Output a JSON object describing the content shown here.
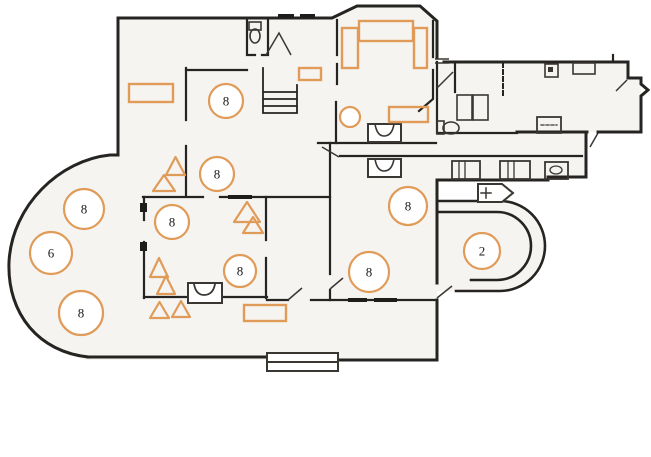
{
  "drawing": {
    "type": "building-floor-plan-with-annotations",
    "colors": {
      "marker": "#E09B58",
      "ink": "#262422",
      "paper": "#FFFFFF",
      "wash": "#F5F4F1",
      "label_color": "#1A1A1A"
    },
    "circle_markers": [
      {
        "id": "c1",
        "label": "8",
        "x": 226,
        "y": 101,
        "r": 17
      },
      {
        "id": "c2",
        "label": "8",
        "x": 217,
        "y": 174,
        "r": 17
      },
      {
        "id": "c3",
        "label": "8",
        "x": 84,
        "y": 209,
        "r": 20
      },
      {
        "id": "c4",
        "label": "8",
        "x": 172,
        "y": 222,
        "r": 17
      },
      {
        "id": "c5",
        "label": "6",
        "x": 51,
        "y": 253,
        "r": 21
      },
      {
        "id": "c6",
        "label": "8",
        "x": 81,
        "y": 313,
        "r": 22
      },
      {
        "id": "c7",
        "label": "8",
        "x": 240,
        "y": 271,
        "r": 16
      },
      {
        "id": "c8",
        "label": "8",
        "x": 369,
        "y": 272,
        "r": 20
      },
      {
        "id": "c9",
        "label": "8",
        "x": 408,
        "y": 206,
        "r": 19
      },
      {
        "id": "c10",
        "label": "2",
        "x": 482,
        "y": 251,
        "r": 18
      },
      {
        "id": "c11",
        "label": "",
        "x": 350,
        "y": 117,
        "r": 10
      }
    ],
    "triangle_markers": [
      {
        "id": "t1",
        "x": 166,
        "y": 157,
        "w": 19,
        "h": 18
      },
      {
        "id": "t2",
        "x": 153,
        "y": 175,
        "w": 22,
        "h": 16
      },
      {
        "id": "t3",
        "x": 150,
        "y": 258,
        "w": 18,
        "h": 19
      },
      {
        "id": "t4",
        "x": 157,
        "y": 276,
        "w": 18,
        "h": 18
      },
      {
        "id": "t5",
        "x": 150,
        "y": 302,
        "w": 19,
        "h": 16
      },
      {
        "id": "t6",
        "x": 172,
        "y": 301,
        "w": 18,
        "h": 16
      },
      {
        "id": "t7",
        "x": 234,
        "y": 202,
        "w": 26,
        "h": 20
      },
      {
        "id": "t8",
        "x": 243,
        "y": 217,
        "w": 20,
        "h": 16
      }
    ],
    "rect_markers": [
      {
        "id": "r1",
        "x": 129,
        "y": 84,
        "w": 44,
        "h": 18
      },
      {
        "id": "r2",
        "x": 299,
        "y": 68,
        "w": 22,
        "h": 12
      },
      {
        "id": "r3",
        "x": 389,
        "y": 107,
        "w": 39,
        "h": 15
      },
      {
        "id": "r4",
        "x": 244,
        "y": 305,
        "w": 42,
        "h": 16
      },
      {
        "id": "bed-head",
        "x": 359,
        "y": 21,
        "w": 54,
        "h": 20
      },
      {
        "id": "bed-left",
        "x": 342,
        "y": 28,
        "w": 16,
        "h": 40
      },
      {
        "id": "bed-right",
        "x": 414,
        "y": 28,
        "w": 13,
        "h": 40
      }
    ]
  }
}
